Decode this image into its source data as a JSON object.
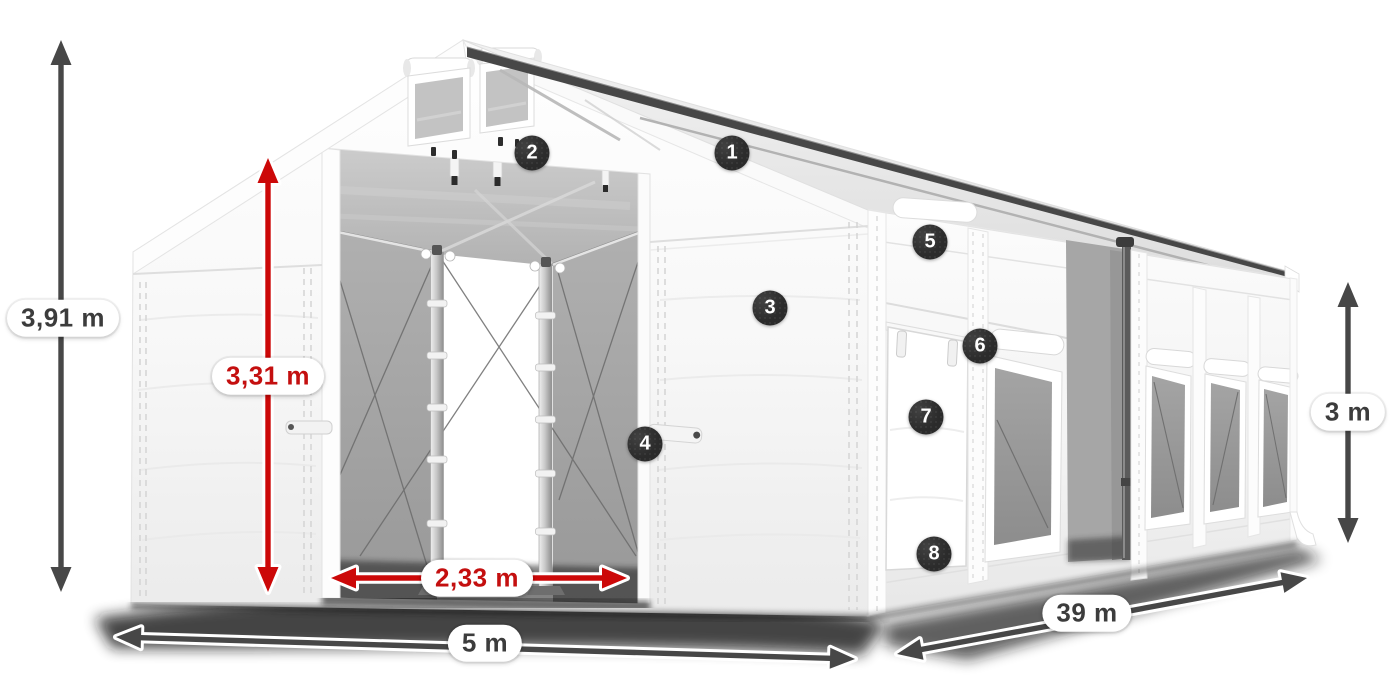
{
  "diagram": {
    "kind": "product-dimension-diagram",
    "subject": "industrial storage tent"
  },
  "dimensions": [
    {
      "id": "total_height",
      "label": "3,91 m",
      "color_role": "dark"
    },
    {
      "id": "entrance_height",
      "label": "3,31 m",
      "color_role": "red"
    },
    {
      "id": "entrance_width",
      "label": "2,33 m",
      "color_role": "red"
    },
    {
      "id": "width",
      "label": "5 m",
      "color_role": "dark"
    },
    {
      "id": "length",
      "label": "39 m",
      "color_role": "dark"
    },
    {
      "id": "side_height",
      "label": "3 m",
      "color_role": "dark"
    }
  ],
  "callouts": [
    {
      "number": "1"
    },
    {
      "number": "2"
    },
    {
      "number": "3"
    },
    {
      "number": "4"
    },
    {
      "number": "5"
    },
    {
      "number": "6"
    },
    {
      "number": "7"
    },
    {
      "number": "8"
    }
  ],
  "colors": {
    "arrow_dark": "#474747",
    "arrow_red": "#cc0808",
    "label_dark": "#3c3c3c",
    "label_red": "#c40f0f",
    "badge_bg": "#2b2b2b",
    "badge_text": "#ffffff",
    "pill_bg": "#ffffff"
  }
}
